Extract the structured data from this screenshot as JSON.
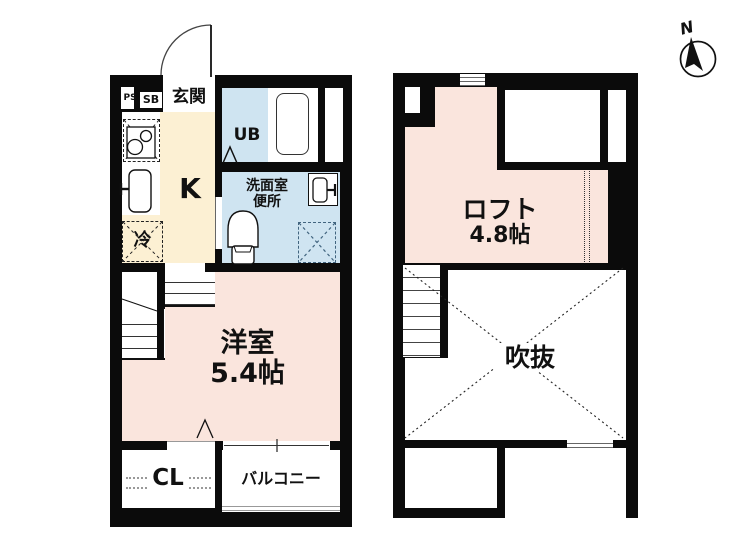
{
  "compass": {
    "north_label": "N"
  },
  "floor1": {
    "ps_label": "PS",
    "sb_label": "SB",
    "entrance_label": "玄関",
    "ub_label": "UB",
    "kitchen_label": "K",
    "washroom_label_line1": "洗面室",
    "washroom_label_line2": "便所",
    "fridge_label": "冷",
    "western_room_name": "洋室",
    "western_room_size": "5.4帖",
    "closet_label": "CL",
    "balcony_label": "バルコニー"
  },
  "floor2": {
    "loft_name": "ロフト",
    "loft_size": "4.8帖",
    "void_label": "吹抜"
  },
  "colors": {
    "wall_black": "#0b0b0b",
    "room_pink": "#fae5dd",
    "kitchen_beige": "#fcf0d3",
    "wet_area_blue": "#cfe4f1",
    "washer_box_blue": "#41647f"
  }
}
